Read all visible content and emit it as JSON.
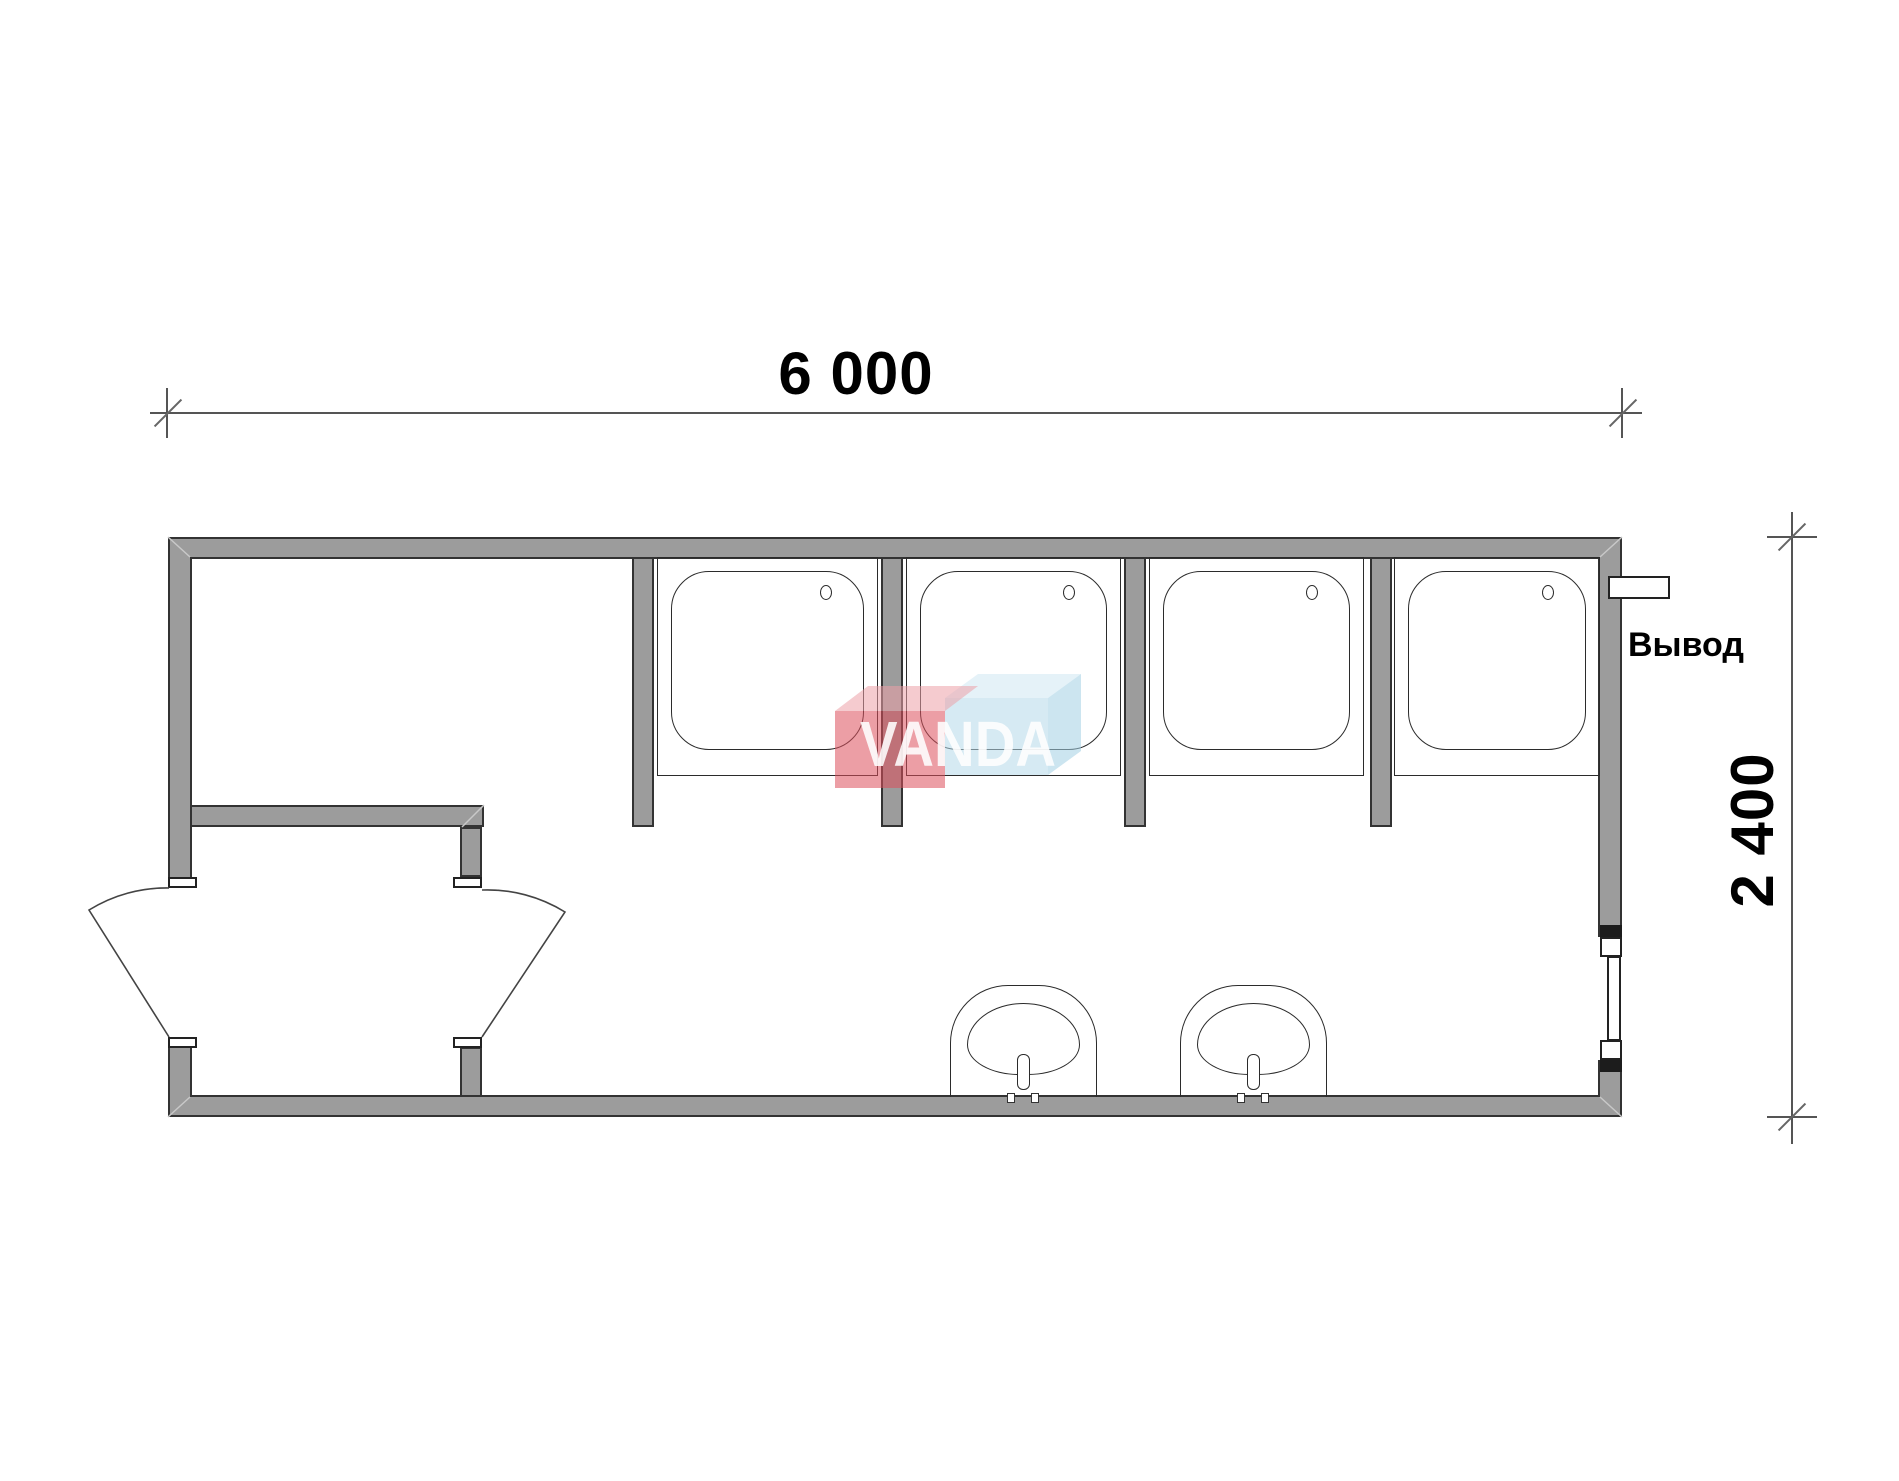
{
  "drawing": {
    "title": "Floor plan of a 6000x2400 modular shower unit",
    "dimensions": {
      "width": {
        "value": "6 000"
      },
      "height": {
        "value": "2 400"
      }
    },
    "labels": {
      "outlet": "Вывод"
    },
    "watermark": {
      "text": "VANDA",
      "red_box_color": "#dd4f5b",
      "blue_box_color": "#b5d9ea"
    },
    "colors": {
      "wall_fill": "#9c9c9c",
      "wall_outline": "#333333",
      "dimension_line": "#555555"
    },
    "fixtures": {
      "shower_cabins": 4,
      "sinks": 2,
      "doors": 2,
      "windows": 1,
      "outlets": 1
    }
  }
}
